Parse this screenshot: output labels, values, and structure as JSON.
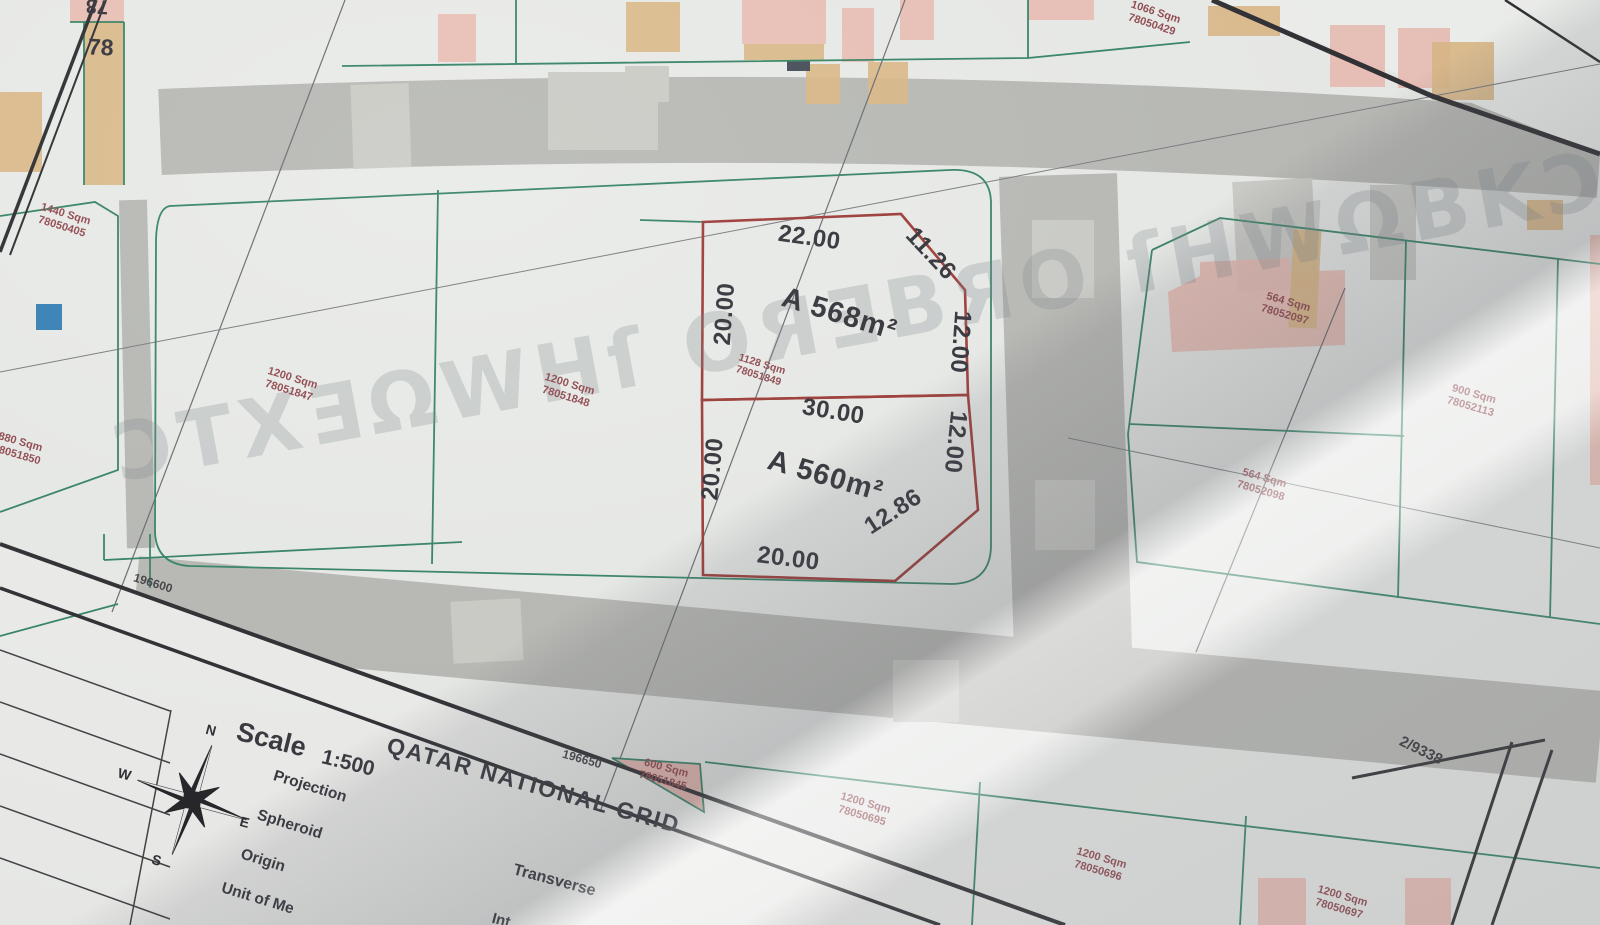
{
  "map": {
    "block_number": "78",
    "block_number_mirrored": "78",
    "sheet_ref": "2/9338",
    "grid_coords": [
      "196600",
      "196650"
    ],
    "watermark": "ƆTXƎΩWHſ OЯƎВЯO ſHWΩBKƆ"
  },
  "highlight_parcel": {
    "upper": {
      "area_label": "A 568m²",
      "dim_top": "22.00",
      "dim_chamfer": "11.26",
      "dim_right": "12.00",
      "dim_left": "20.00"
    },
    "lower": {
      "area_label": "A 560m²",
      "dim_top": "30.00",
      "dim_right": "12.00",
      "dim_chamfer": "12.86",
      "dim_bottom": "20.00",
      "dim_left": "20.00"
    },
    "parcel_info": {
      "area": "1128 Sqm",
      "number": "78051849"
    }
  },
  "plots": [
    {
      "area": "1440 Sqm",
      "number": "78050405",
      "x": 38,
      "y": 208,
      "rot": 17
    },
    {
      "area": "880 Sqm",
      "number": "78051850",
      "x": -6,
      "y": 436,
      "rot": 16
    },
    {
      "area": "1200 Sqm",
      "number": "78051847",
      "x": 265,
      "y": 372,
      "rot": 17
    },
    {
      "area": "1200 Sqm",
      "number": "78051848",
      "x": 542,
      "y": 378,
      "rot": 17
    },
    {
      "area": "1066 Sqm",
      "number": "78050429",
      "x": 1128,
      "y": 6,
      "rot": 18
    },
    {
      "area": "564 Sqm",
      "number": "78052097",
      "x": 1262,
      "y": 296,
      "rot": 16
    },
    {
      "area": "900 Sqm",
      "number": "78052113",
      "x": 1448,
      "y": 388,
      "rot": 16
    },
    {
      "area": "564 Sqm",
      "number": "78052098",
      "x": 1238,
      "y": 472,
      "rot": 16
    },
    {
      "area": "600 Sqm",
      "number": "78051845",
      "x": 640,
      "y": 762,
      "rot": 15
    },
    {
      "area": "1200 Sqm",
      "number": "78050695",
      "x": 838,
      "y": 797,
      "rot": 16
    },
    {
      "area": "1200 Sqm",
      "number": "78050696",
      "x": 1074,
      "y": 852,
      "rot": 16
    },
    {
      "area": "1200 Sqm",
      "number": "78050697",
      "x": 1315,
      "y": 890,
      "rot": 16
    }
  ],
  "legend": {
    "scale_label": "Scale",
    "scale_value": "1:500",
    "grid_name": "QATAR NATIONAL GRID",
    "projection_label": "Projection",
    "spheroid_label": "Spheroid",
    "origin_label": "Origin",
    "unit_label": "Unit of Me",
    "transverse_label": "Transverse",
    "intersection_label": "Int"
  },
  "compass": {
    "north": "N",
    "east": "E",
    "south": "S",
    "west": "W"
  },
  "colors": {
    "parcel_outline": "#993430",
    "plot_label": "#8d4249",
    "boundary_green": "#2e7f60",
    "building_tan": "#d9b580",
    "building_pink": "#e8b7ad",
    "road_gray": "#b6b7b2",
    "marker_blue": "#2f7cb4"
  }
}
